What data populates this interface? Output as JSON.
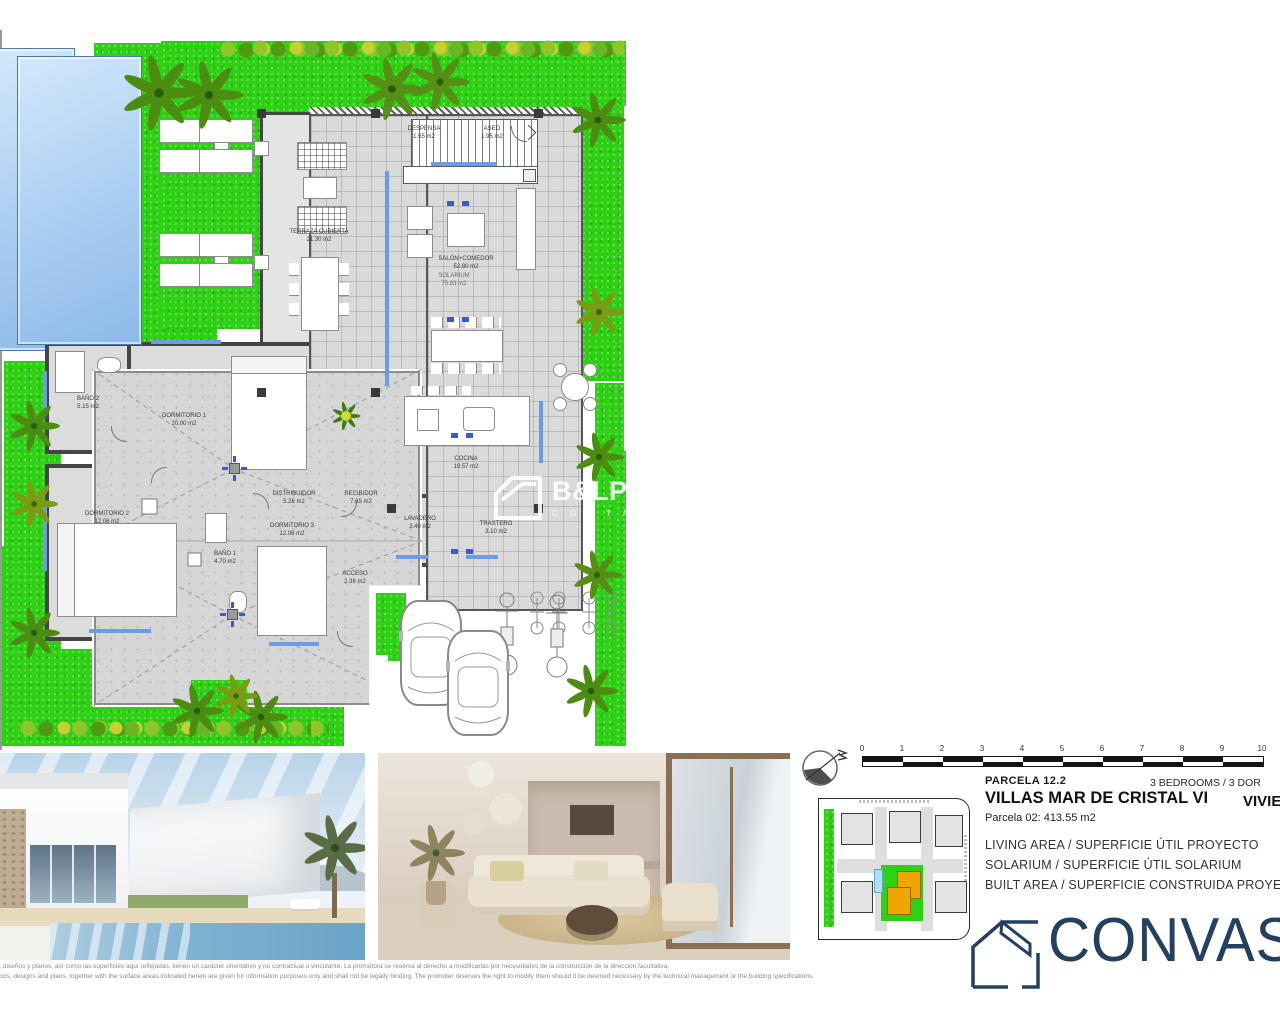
{
  "plans": {
    "ground_floor": {
      "rooms": [
        {
          "name": "TERRAZA CUBIERTA",
          "area": "21.30 m2"
        },
        {
          "name": "DESPENSA",
          "area": "1.55 m2"
        },
        {
          "name": "ASEO",
          "area": "1.95 m2"
        },
        {
          "name": "SALÓN+COMEDOR",
          "area": "52.80 m2"
        },
        {
          "name": "COCINA",
          "area": "10.57 m2"
        },
        {
          "name": "BAÑO 2",
          "area": "5.15 m2"
        },
        {
          "name": "DORMITORIO 1",
          "area": "20.00 m2"
        },
        {
          "name": "DORMITORIO 2",
          "area": "12.06 m2"
        },
        {
          "name": "BAÑO 1",
          "area": "4.70 m2"
        },
        {
          "name": "DORMITORIO 3",
          "area": "12.06 m2"
        },
        {
          "name": "DISTRIBUIDOR",
          "area": "5.26 m2"
        },
        {
          "name": "RECIBIDOR",
          "area": "7.65 m2"
        },
        {
          "name": "LAVADERO",
          "area": "3.40 m2"
        },
        {
          "name": "TRASTERO",
          "area": "3.10 m2"
        },
        {
          "name": "ACCESO",
          "area": "2.36 m2"
        }
      ]
    },
    "roof_plan": {
      "rooms": [
        {
          "name": "SOLARIUM",
          "area": "75.83 m2"
        }
      ]
    }
  },
  "watermark": {
    "brand": "B&LPROMOTIONS",
    "tagline": "C O S T A   B L A N C A"
  },
  "scale_bar": {
    "ticks": [
      "0",
      "1",
      "2",
      "3",
      "4",
      "5",
      "6",
      "7",
      "8",
      "9",
      "10"
    ]
  },
  "info_panel": {
    "parcela_label": "PARCELA 12.2",
    "bedrooms_label": "3 BEDROOMS / 3 DOR",
    "project_title": "VILLAS MAR DE CRISTAL VI",
    "vivienda_label": "VIVIE",
    "parcela_detail": "Parcela 02:  413.55 m2",
    "area_lines": [
      "LIVING AREA / SUPERFICIE ÚTIL PROYECTO",
      "SOLARIUM / SUPERFICIE ÚTIL SOLARIUM",
      "BUILT AREA / SUPERFICIE CONSTRUIDA PROYECTO"
    ]
  },
  "logo": {
    "visible_text": "CONVAS"
  },
  "disclaimer": {
    "line_es": "s, diseños y planos, así como las superficies aquí reflejadas, tienen un carácter orientativo y no contractual o vinculante. La promotora se reserva al derecho a modificarlas por necesidades de la construcción de la dirección facultativa.",
    "line_en": "tions, designs and plans, together with the surface areas indicated herein are given for information purposes only and shall not be legally binding. The promoter reserves the right to modify them should it be deemed necessary by the technical management or the building specifications."
  },
  "colors": {
    "grass": "#2ed014",
    "pool": "#a9cdf1",
    "brand_navy": "#24405f",
    "highlight_orange": "#f0a500"
  }
}
